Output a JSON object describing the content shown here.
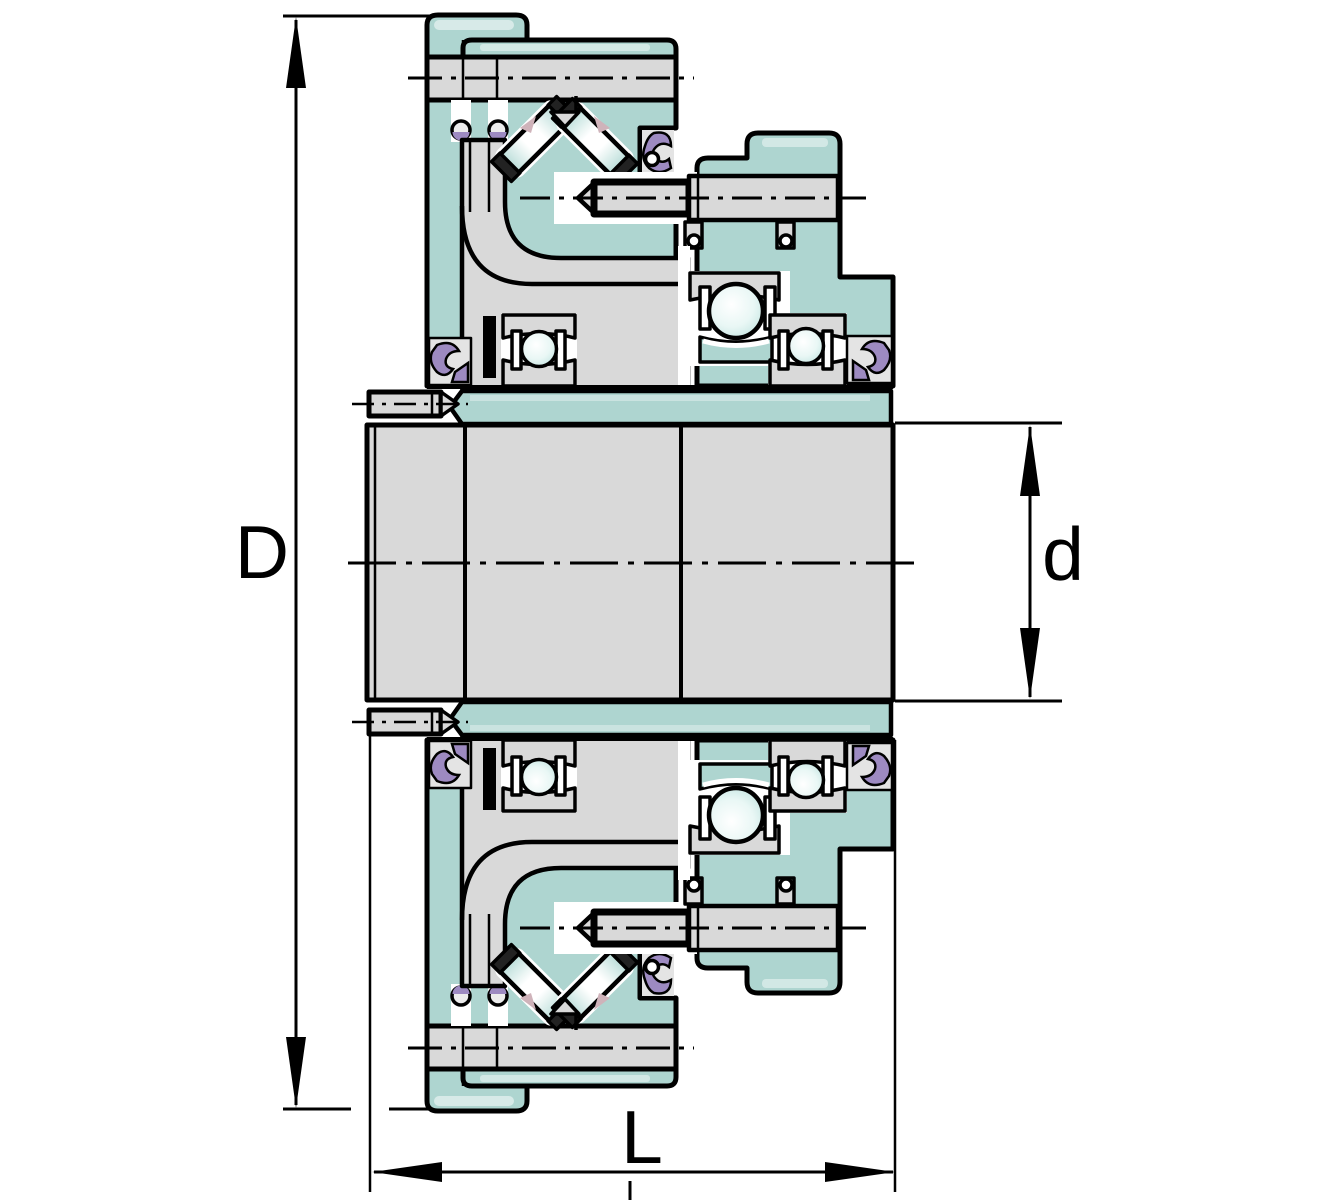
{
  "diagram": {
    "description": "Engineering cross-section drawing of a flanged bearing / backstop clutch unit, symmetric about a horizontal centerline",
    "labels": {
      "outer_diameter": "D",
      "bore_diameter": "d",
      "width": "L"
    },
    "colors": {
      "housing_teal": "#aed5d0",
      "metal_gray": "#d9d9d9",
      "seal_purple": "#9d8ac1",
      "accent_pink": "#cfb3ba",
      "outline_black": "#000000",
      "background": "#ffffff"
    }
  }
}
